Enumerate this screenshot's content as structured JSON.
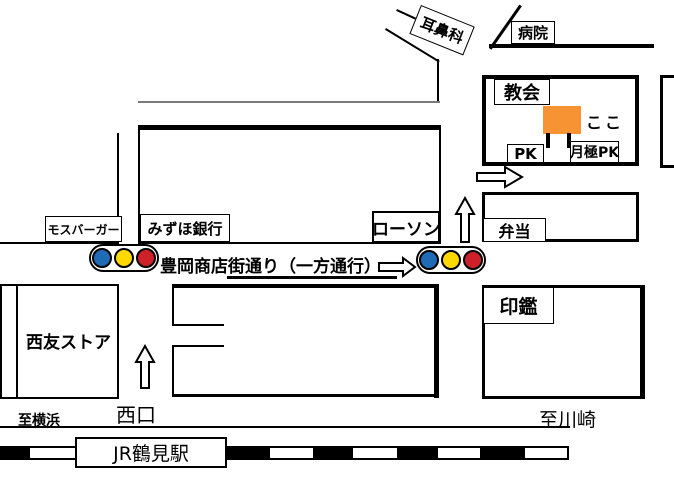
{
  "labels": {
    "ent_clinic": "耳鼻科",
    "hospital": "病院",
    "church": "教会",
    "here": "ここ",
    "pk": "PK",
    "monthly_pk": "月極PK",
    "mos_burger": "モスバーガー",
    "mizuho_bank": "みずほ銀行",
    "lawson": "ローソン",
    "bento": "弁当",
    "street_name": "豊岡商店街通り（一方通行）",
    "seal_shop": "印鑑",
    "seiyu_store": "西友ストア",
    "to_yokohama": "至横浜",
    "west_exit": "西口",
    "to_kawasaki": "至川崎",
    "station": "JR鶴見駅"
  },
  "colors": {
    "here_marker_orange": "#F79333",
    "signal_blue": "#1F6BB5",
    "signal_yellow": "#FFD800",
    "signal_red": "#CE2029"
  }
}
